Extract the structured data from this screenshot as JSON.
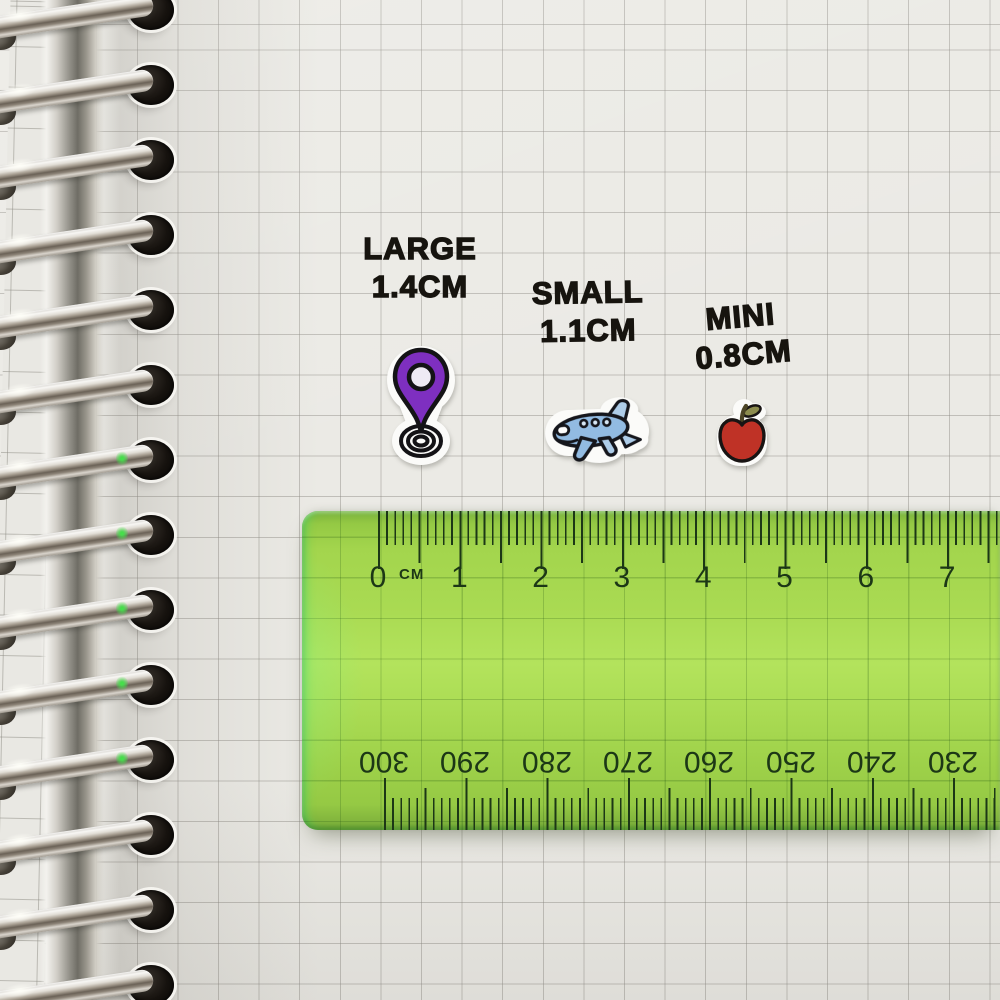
{
  "scene": {
    "description": "Photo of a spiral-bound grid notebook page showing three die-cut sticker size samples above a transparent green ruler"
  },
  "size_labels": [
    {
      "name": "LARGE",
      "size": "1.4CM"
    },
    {
      "name": "SMALL",
      "size": "1.1CM"
    },
    {
      "name": "MINI",
      "size": "0.8CM"
    }
  ],
  "stickers": [
    {
      "name": "location-pin",
      "main_color": "#7e2fc0",
      "accent_color": "#eeeaf4",
      "outline_color": "#141316"
    },
    {
      "name": "airplane",
      "main_color": "#92bbe2",
      "accent_color": "#aecde9",
      "window_color": "#d6e6f4",
      "outline_color": "#15161c"
    },
    {
      "name": "apple",
      "main_color": "#bf3226",
      "leaf_color": "#8c8c4e",
      "stem_color": "#4c4526",
      "outline_color": "#181413"
    }
  ],
  "ruler": {
    "unit_label": "CM",
    "top_scale": [
      "0",
      "1",
      "2",
      "3",
      "4",
      "5",
      "6",
      "7"
    ],
    "bottom_scale": [
      "300",
      "290",
      "280",
      "270",
      "260",
      "250",
      "240",
      "230"
    ],
    "body_color": "#a3d64d",
    "marking_color": "#1c3716"
  },
  "notebook": {
    "paper_color": "#ebeae5",
    "grid_color": "#c7c5bf",
    "binding": "metal spiral rings"
  }
}
